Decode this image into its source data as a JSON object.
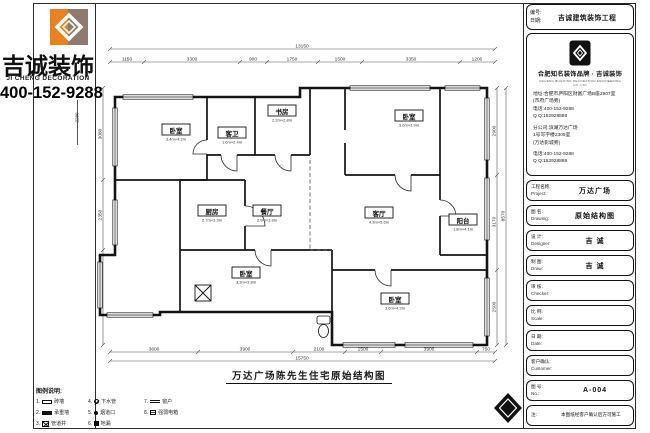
{
  "brand": {
    "name": "吉诚装饰",
    "name_en": "JI CHENG DECORATION",
    "phone": "400-152-9288",
    "left_outer_dim": "2280"
  },
  "colors": {
    "accent_orange": "#e8821e",
    "taupe": "#8d7b70",
    "line": "#1a1a1a"
  },
  "drawing": {
    "title": "万达广场陈先生住宅原始结构图",
    "rooms": [
      {
        "name": "卧室",
        "dim": "3.4m×4.2m"
      },
      {
        "name": "客卫",
        "dim": "1.6m×2.4m"
      },
      {
        "name": "书房",
        "dim": "2.2m×2.8m"
      },
      {
        "name": "卧室",
        "dim": "3.6m×3.9m"
      },
      {
        "name": "厨房",
        "dim": "2.7m×3.3m"
      },
      {
        "name": "餐厅",
        "dim": "2.9m×3.8m"
      },
      {
        "name": "客厅",
        "dim": "4.3m×5.6m"
      },
      {
        "name": "阳台",
        "dim": "1.8m×4.1m"
      },
      {
        "name": "卧室",
        "dim": "3.3m×3.8m"
      },
      {
        "name": "卧室",
        "dim": "3.6m×4.2m"
      }
    ],
    "dims": {
      "top": [
        "1150",
        "3300",
        "900",
        "1750",
        "1500",
        "3350",
        "1200"
      ],
      "top_total": "13150",
      "bottom": [
        "3600",
        "3900",
        "2100",
        "1500",
        "3900",
        "750"
      ],
      "bottom_total": "15750",
      "left": [
        "3080",
        "2350",
        "3180"
      ],
      "right": [
        "2900",
        "3170",
        "2500"
      ],
      "right_total": "8570"
    }
  },
  "legend": {
    "title": "图例说明:",
    "items": [
      {
        "no": "1.",
        "label": "砖墙"
      },
      {
        "no": "2.",
        "label": "承重墙"
      },
      {
        "no": "3.",
        "label": "管道井"
      },
      {
        "no": "4.",
        "label": "下水管"
      },
      {
        "no": "5.",
        "label": "烟道口"
      },
      {
        "no": "6.",
        "label": "地漏"
      },
      {
        "no": "7.",
        "label": "窗户"
      },
      {
        "no": "8.",
        "label": "强弱电箱"
      }
    ]
  },
  "title_block": {
    "header": {
      "no_label": "编号:",
      "date_label": "日期:",
      "company_short": "吉诚建筑装饰工程"
    },
    "company_card": {
      "tagline": "合肥知名装饰品牌 · 吉诚装饰",
      "tagline_en": "JICHENG BUILDING DECORATION ENGINEERING CO.,LTD",
      "lines1": [
        "地址:合肥市庐阳区财富广场B座2907室",
        "(市府广场旁)",
        "电话:400-152-9288",
        "Q Q:152928888"
      ],
      "lines2": [
        "分公司:滨湖万达广场",
        "1号写字楼2305室",
        "(万达影城旁)"
      ],
      "lines3": [
        "电话:400-152-9288",
        "Q Q:152928888"
      ]
    },
    "fields": [
      {
        "label": "工程名称:",
        "label_en": "Project:",
        "value": "万达广场"
      },
      {
        "label": "图  名:",
        "label_en": "Drawing:",
        "value": "原始结构图"
      },
      {
        "label": "设  计:",
        "label_en": "Designer:",
        "value": "吉 诚"
      },
      {
        "label": "制  图:",
        "label_en": "Draw:",
        "value": "吉 诚"
      },
      {
        "label": "审  核:",
        "label_en": "Checker:",
        "value": ""
      },
      {
        "label": "比  例:",
        "label_en": "Scale:",
        "value": ""
      },
      {
        "label": "日  期:",
        "label_en": "Date:",
        "value": ""
      },
      {
        "label": "客户确认:",
        "label_en": "Customer:",
        "value": ""
      },
      {
        "label": "图  号:",
        "label_en": "No.:",
        "value": "A-004"
      },
      {
        "label": "注:",
        "label_en": "",
        "value": "本图纸经客户确认后方可施工"
      }
    ]
  }
}
